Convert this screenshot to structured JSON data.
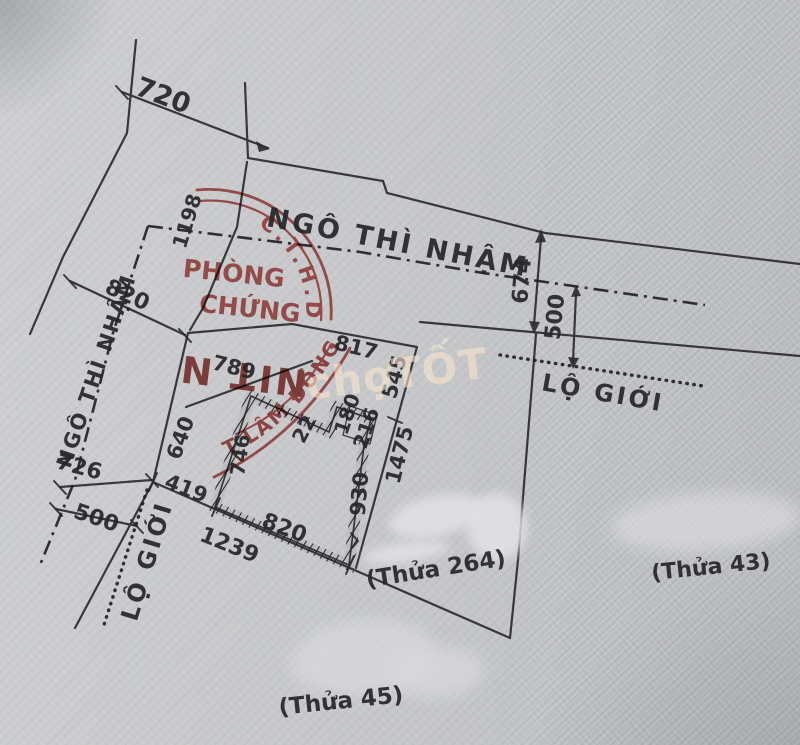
{
  "document": {
    "kind": "cadastral-survey-sketch",
    "colors": {
      "ink": "#26262b",
      "stamp_red": "#b4403c",
      "stamp_dark_red": "#8d2b28",
      "paper": "#c7c9cb",
      "watermark": "#fae4cc"
    }
  },
  "watermark": {
    "text": "chợTỐT"
  },
  "stamp": {
    "ring_top_text": "C.T.H.D",
    "ring_bottom_text": "T LÂM ĐỒNG ★",
    "word_line1": "PHÒNG",
    "word_line2": "CHỨNG",
    "center_inverted_text": "NIT N"
  },
  "labels": [
    {
      "name": "dim-720",
      "text": "720",
      "x": 163,
      "y": 96,
      "rot": 21,
      "size": 27
    },
    {
      "name": "dim-1198",
      "text": "1198",
      "x": 187,
      "y": 221,
      "rot": -73,
      "size": 20
    },
    {
      "name": "street-ngo-thi-nham-top",
      "text": "NGÔ THÌ NHẬM",
      "x": 398,
      "y": 243,
      "rot": 11,
      "size": 27,
      "ls": 3
    },
    {
      "name": "dim-674",
      "text": "674",
      "x": 523,
      "y": 281,
      "rot": -85,
      "size": 22
    },
    {
      "name": "street-ngo-thi-nham-left",
      "text": "NGÔ THÌ NHẬM",
      "x": 97,
      "y": 371,
      "rot": -71,
      "size": 21,
      "ls": 2
    },
    {
      "name": "dim-820-left",
      "text": "820",
      "x": 127,
      "y": 296,
      "rot": 24,
      "size": 22
    },
    {
      "name": "dim-726",
      "text": "726",
      "x": 79,
      "y": 468,
      "rot": 15,
      "size": 22
    },
    {
      "name": "dim-500-left",
      "text": "500",
      "x": 96,
      "y": 519,
      "rot": 19,
      "size": 22
    },
    {
      "name": "dim-500-right",
      "text": "500",
      "x": 556,
      "y": 317,
      "rot": -84,
      "size": 22
    },
    {
      "name": "road-lo-gioi-right",
      "text": "LỘ GIỚI",
      "x": 603,
      "y": 393,
      "rot": 10,
      "size": 24,
      "ls": 3
    },
    {
      "name": "road-lo-gioi-left",
      "text": "LỘ GIỚI",
      "x": 147,
      "y": 561,
      "rot": -73,
      "size": 24,
      "ls": 3
    },
    {
      "name": "dim-789",
      "text": "789",
      "x": 234,
      "y": 368,
      "rot": 14,
      "size": 21
    },
    {
      "name": "dim-817",
      "text": "817",
      "x": 356,
      "y": 348,
      "rot": 14,
      "size": 21
    },
    {
      "name": "dim-545",
      "text": "545",
      "x": 395,
      "y": 377,
      "rot": -75,
      "size": 21
    },
    {
      "name": "dim-180",
      "text": "180",
      "x": 347,
      "y": 414,
      "rot": -71,
      "size": 20
    },
    {
      "name": "dim-216",
      "text": "216",
      "x": 366,
      "y": 428,
      "rot": -71,
      "size": 20
    },
    {
      "name": "dim-1475",
      "text": "1475",
      "x": 400,
      "y": 455,
      "rot": -76,
      "size": 21
    },
    {
      "name": "dim-930",
      "text": "930",
      "x": 360,
      "y": 494,
      "rot": -85,
      "size": 21
    },
    {
      "name": "dim-746",
      "text": "746",
      "x": 240,
      "y": 455,
      "rot": -82,
      "size": 20
    },
    {
      "name": "dim-22",
      "text": "22",
      "x": 304,
      "y": 429,
      "rot": -62,
      "size": 20
    },
    {
      "name": "dim-640",
      "text": "640",
      "x": 181,
      "y": 438,
      "rot": -70,
      "size": 21
    },
    {
      "name": "dim-419",
      "text": "419",
      "x": 186,
      "y": 489,
      "rot": 22,
      "size": 21
    },
    {
      "name": "dim-820-bottom",
      "text": "820",
      "x": 284,
      "y": 529,
      "rot": 21,
      "size": 22
    },
    {
      "name": "dim-1239",
      "text": "1239",
      "x": 229,
      "y": 546,
      "rot": 22,
      "size": 22
    },
    {
      "name": "parcel-thua-264",
      "text": "(Thửa 264)",
      "x": 436,
      "y": 570,
      "rot": -9,
      "size": 23
    },
    {
      "name": "parcel-thua-43",
      "text": "(Thửa 43)",
      "x": 711,
      "y": 568,
      "rot": -6,
      "size": 22
    },
    {
      "name": "parcel-thua-45",
      "text": "(Thửa 45)",
      "x": 341,
      "y": 702,
      "rot": -6,
      "size": 23
    }
  ]
}
